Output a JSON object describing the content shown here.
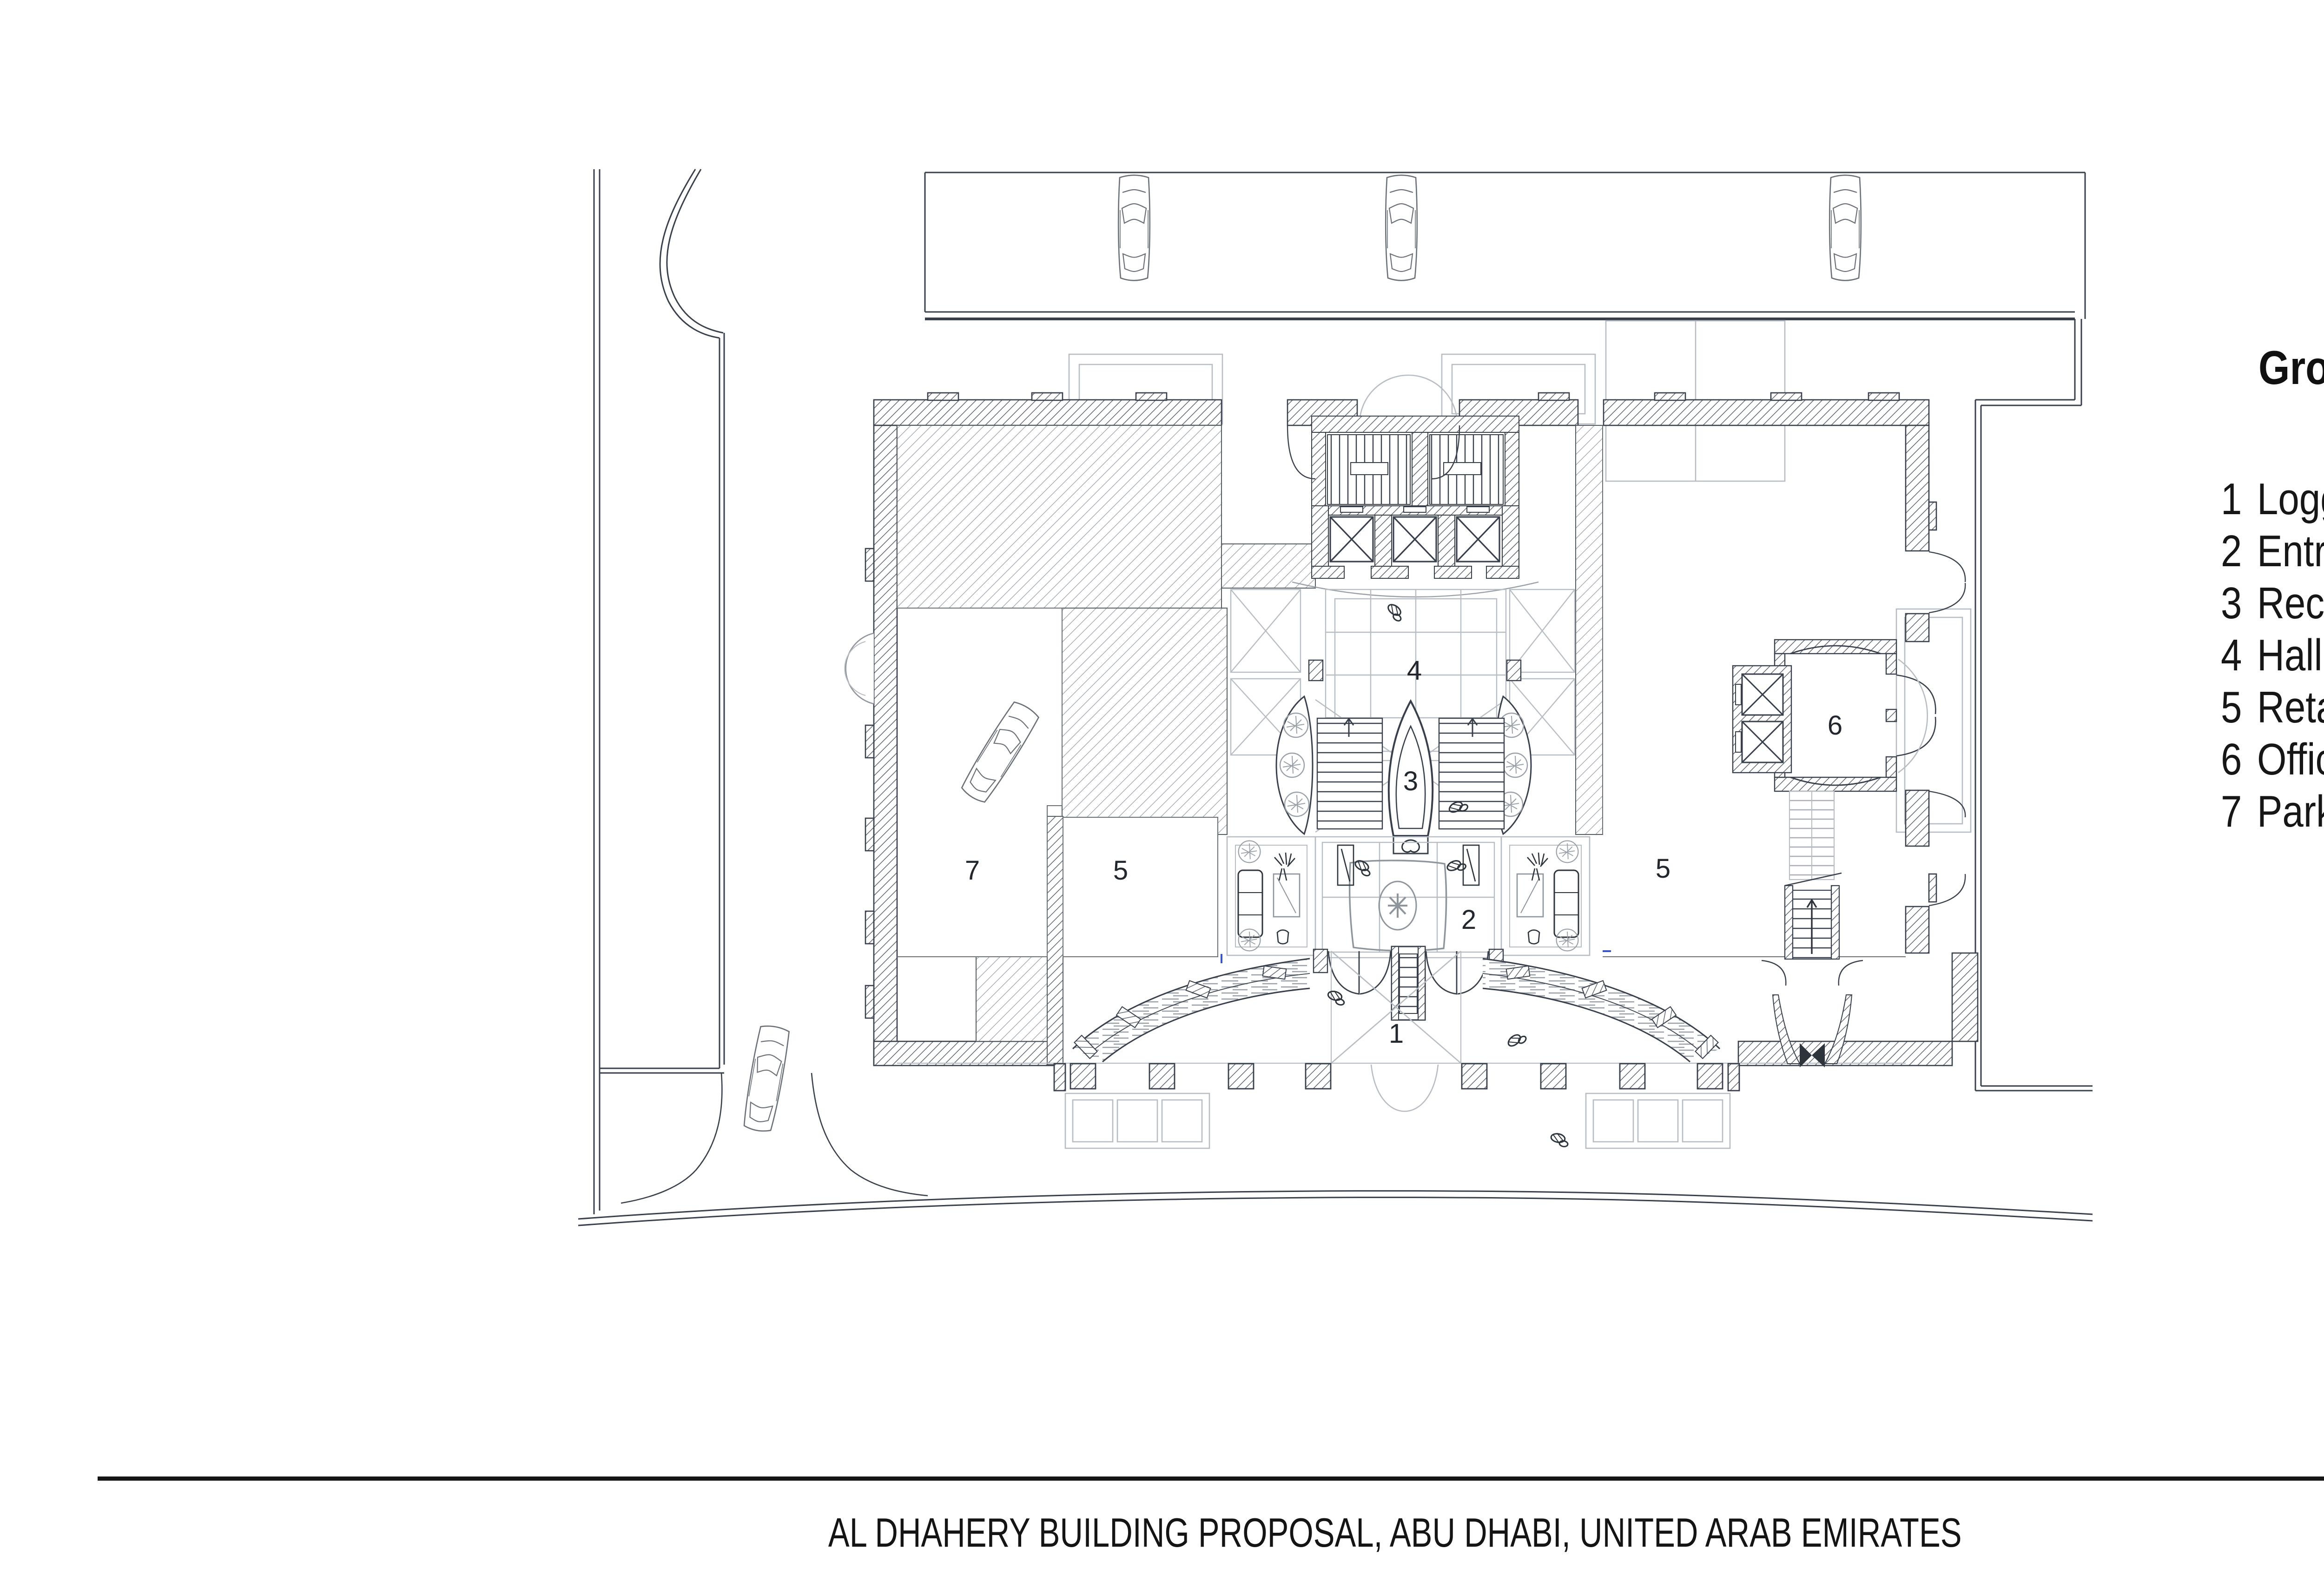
{
  "legend": {
    "title": "Ground Floor Plan",
    "items": [
      {
        "num": "1",
        "label": "Loggia"
      },
      {
        "num": "2",
        "label": "Entrance and lounge"
      },
      {
        "num": "3",
        "label": "Reception"
      },
      {
        "num": "4",
        "label": "Hall"
      },
      {
        "num": "5",
        "label": "Retail"
      },
      {
        "num": "6",
        "label": "Offices entrance"
      },
      {
        "num": "7",
        "label": "Parking entrance"
      }
    ]
  },
  "plan": {
    "room_numbers": {
      "loggia": "1",
      "entrance_lounge": "2",
      "reception": "3",
      "hall": "4",
      "retail_left": "5",
      "retail_right": "5",
      "offices_entrance": "6",
      "parking_entrance": "7"
    }
  },
  "copyright": "© XCASSIA GLOBAL LIMITED . ALL RIGHTS RESERVED",
  "footer": {
    "caption": "AL DHAHERY BUILDING PROPOSAL, ABU DHABI, UNITED ARAB EMIRATES",
    "logo": "XCASSIA"
  },
  "colors": {
    "line_dark": "#39404b",
    "line_light": "#b8bdc3",
    "line_mid": "#8f959c",
    "accent_blue": "#3b55c4",
    "text": "#161616"
  }
}
